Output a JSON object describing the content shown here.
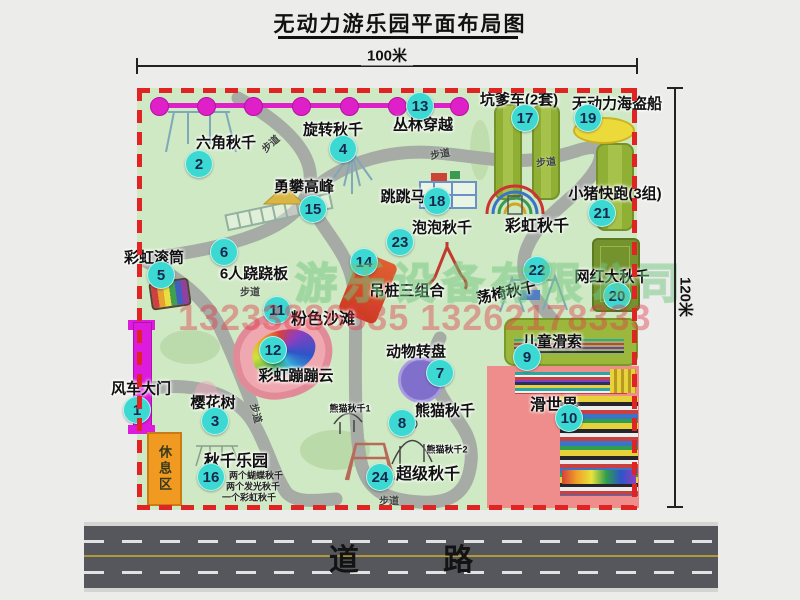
{
  "title": "无动力游乐园平面布局图",
  "dimensions": {
    "width_label": "100米",
    "height_label": "120米"
  },
  "road": {
    "label": "道 路"
  },
  "watermark": {
    "company": "游乐设备有限公司",
    "phone": "13233886535 13262178333"
  },
  "rest_area": {
    "label": "休息区"
  },
  "map": {
    "items": [
      {
        "num": "1",
        "label": "风车大门",
        "cx": 137,
        "cy": 410,
        "lx": 141,
        "ly": 388
      },
      {
        "num": "2",
        "label": "六角秋千",
        "cx": 199,
        "cy": 164,
        "lx": 226,
        "ly": 142
      },
      {
        "num": "3",
        "label": "樱花树",
        "cx": 215,
        "cy": 421,
        "lx": 213,
        "ly": 402
      },
      {
        "num": "4",
        "label": "旋转秋千",
        "cx": 343,
        "cy": 149,
        "lx": 333,
        "ly": 129
      },
      {
        "num": "5",
        "label": "彩虹滚筒",
        "cx": 161,
        "cy": 275,
        "lx": 154,
        "ly": 257
      },
      {
        "num": "6",
        "label": "6人跷跷板",
        "cx": 224,
        "cy": 252,
        "lx": 254,
        "ly": 273
      },
      {
        "num": "7",
        "label": "动物转盘",
        "cx": 440,
        "cy": 373,
        "lx": 416,
        "ly": 351
      },
      {
        "num": "8",
        "label": "熊猫秋千",
        "cx": 402,
        "cy": 423,
        "lx": 445,
        "ly": 410
      },
      {
        "num": "9",
        "label": "儿童滑索",
        "cx": 527,
        "cy": 357,
        "lx": 552,
        "ly": 341
      },
      {
        "num": "10",
        "label": "滑世界",
        "cx": 569,
        "cy": 418,
        "lx": 554,
        "ly": 403,
        "fs": 16
      },
      {
        "num": "11",
        "label": "粉色沙滩",
        "cx": 277,
        "cy": 310,
        "lx": 323,
        "ly": 317,
        "fs": 16
      },
      {
        "num": "12",
        "label": "彩虹蹦蹦云",
        "cx": 273,
        "cy": 350,
        "lx": 296,
        "ly": 375
      },
      {
        "num": "13",
        "label": "丛林穿越",
        "cx": 420,
        "cy": 106,
        "lx": 423,
        "ly": 124
      },
      {
        "num": "14",
        "label": "吊桩三组合",
        "cx": 364,
        "cy": 262,
        "lx": 407,
        "ly": 290
      },
      {
        "num": "15",
        "label": "勇攀高峰",
        "cx": 313,
        "cy": 209,
        "lx": 304,
        "ly": 186
      },
      {
        "num": "16",
        "label": "秋千乐园",
        "cx": 211,
        "cy": 477,
        "lx": 236,
        "ly": 459,
        "fs": 16
      },
      {
        "num": "17",
        "label": "坑爹车(2套)",
        "cx": 525,
        "cy": 118,
        "lx": 519,
        "ly": 99
      },
      {
        "num": "18",
        "label": "跳跳马",
        "cx": 437,
        "cy": 201,
        "lx": 403,
        "ly": 196
      },
      {
        "num": "19",
        "label": "无动力海盗船",
        "cx": 588,
        "cy": 118,
        "lx": 617,
        "ly": 103
      },
      {
        "num": "20",
        "label": "网红大秋千",
        "cx": 617,
        "cy": 296,
        "lx": 612,
        "ly": 276
      },
      {
        "num": "21",
        "label": "小猪快跑(3组)",
        "cx": 602,
        "cy": 213,
        "lx": 615,
        "ly": 193
      },
      {
        "num": "22",
        "label": "荡椅秋千",
        "cx": 537,
        "cy": 270,
        "lx": 506,
        "ly": 292,
        "rot": -12
      },
      {
        "num": "23",
        "label": "泡泡秋千",
        "cx": 400,
        "cy": 242,
        "lx": 442,
        "ly": 227
      },
      {
        "num": "24",
        "label": "超级秋千",
        "cx": 380,
        "cy": 477,
        "lx": 428,
        "ly": 472,
        "fs": 16
      }
    ],
    "extra_labels": [
      {
        "text": "彩虹秋千",
        "x": 537,
        "y": 224,
        "fs": 16
      },
      {
        "text": "熊猫秋千1",
        "x": 350,
        "y": 408,
        "fs": 9
      },
      {
        "text": "熊猫秋千2",
        "x": 447,
        "y": 449,
        "fs": 9
      }
    ],
    "path_labels": [
      {
        "text": "步道",
        "x": 270,
        "y": 143,
        "rot": -42
      },
      {
        "text": "步道",
        "x": 440,
        "y": 153,
        "rot": -10
      },
      {
        "text": "步道",
        "x": 546,
        "y": 161,
        "rot": -5
      },
      {
        "text": "步道",
        "x": 250,
        "y": 291,
        "rot": 0
      },
      {
        "text": "步道",
        "x": 257,
        "y": 413,
        "rot": 75
      },
      {
        "text": "步道",
        "x": 389,
        "y": 500,
        "rot": 0
      }
    ],
    "swing_park_notes": [
      {
        "text": "两个蝴蝶秋千",
        "x": 256,
        "y": 475
      },
      {
        "text": "两个发光秋千",
        "x": 253,
        "y": 486
      },
      {
        "text": "一个彩虹秋千",
        "x": 249,
        "y": 497
      }
    ],
    "zipline": {
      "y": 105,
      "dot_xs": [
        158,
        205,
        252,
        300,
        348,
        396,
        458
      ]
    }
  },
  "colors": {
    "map_green": "#cfe9c4",
    "border_red": "#e02424",
    "badge_teal": "#3cd9d2",
    "path_gray": "#a6aba5",
    "road_gray": "#55575d",
    "gate_magenta": "#dc1bdc",
    "rest_orange": "#f09a22",
    "beach_pink": "#f0a8b0",
    "pirate_yellow": "#ecd93a",
    "equip_green": "#9cb83c",
    "zipline_magenta": "#df20c8"
  }
}
